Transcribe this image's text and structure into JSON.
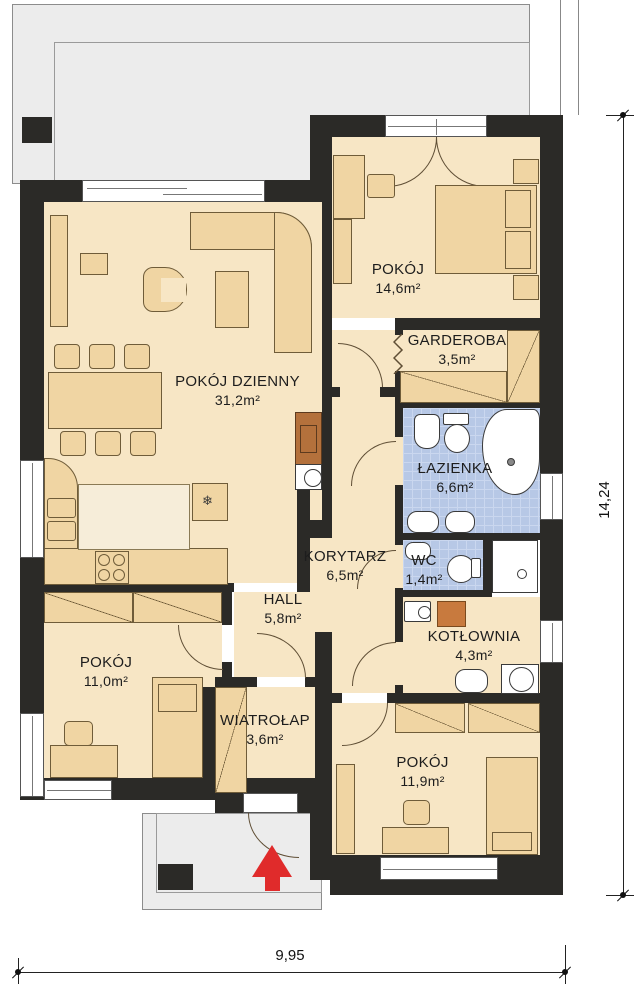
{
  "rooms": [
    {
      "name": "POKÓJ DZIENNY",
      "area": "31,2m²"
    },
    {
      "name": "POKÓJ",
      "area": "14,6m²"
    },
    {
      "name": "GARDEROBA",
      "area": "3,5m²"
    },
    {
      "name": "ŁAZIENKA",
      "area": "6,6m²"
    },
    {
      "name": "KORYTARZ",
      "area": "6,5m²"
    },
    {
      "name": "WC",
      "area": "1,4m²"
    },
    {
      "name": "HALL",
      "area": "5,8m²"
    },
    {
      "name": "KOTŁOWNIA",
      "area": "4,3m²"
    },
    {
      "name": "POKÓJ",
      "area": "11,0m²"
    },
    {
      "name": "WIATROŁAP",
      "area": "3,6m²"
    },
    {
      "name": "POKÓJ",
      "area": "11,9m²"
    }
  ],
  "dimensions": {
    "width": "9,95",
    "height": "14,24"
  },
  "symbols": {
    "fridge": "❄"
  },
  "colors": {
    "wall": "#2b2a27",
    "floor": "#f7e6c5",
    "furniture": "#f0d5a3",
    "tile": "#b7c8e6",
    "boiler": "#c87a3e",
    "fireplace": "#b4713c",
    "arrow": "#e02b2b",
    "outdoor": "#ececec"
  }
}
